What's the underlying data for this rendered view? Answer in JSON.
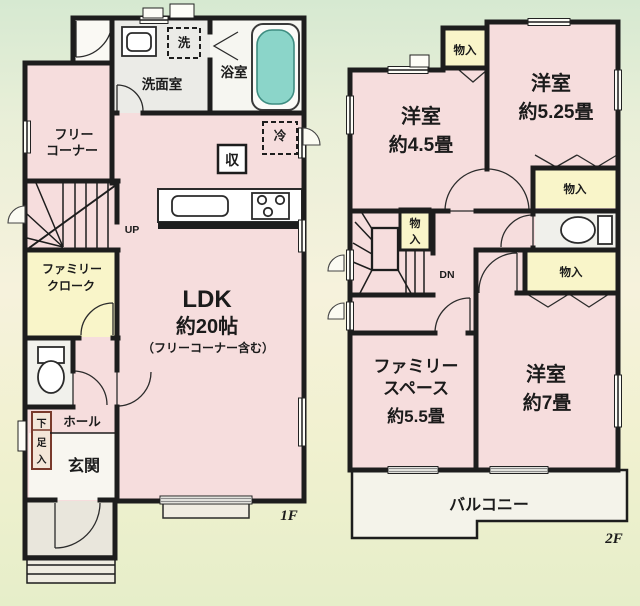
{
  "f1": {
    "label": "1F",
    "free_corner_l1": "フリー",
    "free_corner_l2": "コーナー",
    "washroom": "洗面室",
    "bathroom": "浴室",
    "washer": "洗",
    "fridge": "冷",
    "storage": "収",
    "up": "UP",
    "ldk_l1": "LDK",
    "ldk_l2": "約20帖",
    "ldk_l3": "（フリーコーナー含む）",
    "cloak_l1": "ファミリー",
    "cloak_l2": "クローク",
    "hall": "ホール",
    "entrance": "玄関",
    "shoe_c1": "下",
    "shoe_c2": "足",
    "shoe_c3": "入"
  },
  "f2": {
    "label": "2F",
    "room45_l1": "洋室",
    "room45_l2": "約4.5畳",
    "room525_l1": "洋室",
    "room525_l2": "約5.25畳",
    "room7_l1": "洋室",
    "room7_l2": "約7畳",
    "family_l1": "ファミリー",
    "family_l2": "スペース",
    "family_l3": "約5.5畳",
    "balcony": "バルコニー",
    "closet_top": "物入",
    "closet_mid": "物入",
    "closet_low": "物入",
    "closet_stair_c1": "物",
    "closet_stair_c2": "入",
    "dn": "DN"
  },
  "colors": {
    "wall": "#1d1d1d",
    "room_pink": "#f6dddd",
    "closet_yellow": "#f9f5c9",
    "bathtub_teal": "#8bd5c9",
    "background_top": "#d6e9d1",
    "background_bottom": "#e6eec9"
  }
}
